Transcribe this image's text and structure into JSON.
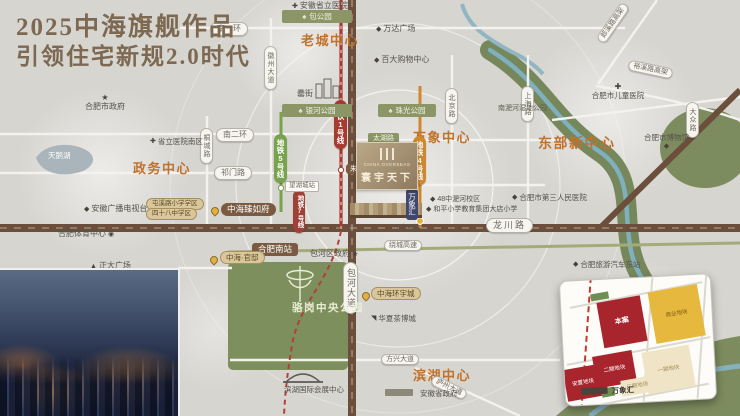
{
  "title": {
    "line1": "2025中海旗舰作品",
    "line2": "引领住宅新规2.0时代"
  },
  "centers": {
    "zhengwu": "政务中心",
    "laocheng": "老城中心",
    "wanxiang": "万象中心",
    "dongbu": "东部新中心",
    "binhu": "滨湖中心"
  },
  "roads": {
    "nanyihuan": "南一环",
    "nanerhuan": "南二环",
    "qimenlu": "祁门路",
    "tongchenglu": "桐城路",
    "huizhoudadao": "徽州大道",
    "beijinglu": "北京路",
    "shanghailu": "上海路",
    "longchuanlu": "龙川路",
    "baohedadao": "包河大道",
    "raochenggaosu": "绕城高速",
    "fangxingdadao": "方兴大道",
    "luzhoudadao": "庐州大道",
    "langxigaojia": "郎溪路高架",
    "yuxigaojia": "裕溪路高架",
    "taihulu": "太湖路",
    "feihelu": "淝河路",
    "dazhonglu": "大众路"
  },
  "metro": {
    "line1": "地铁1号线",
    "line4": "地铁4号线",
    "line5": "地铁5号线",
    "line7": "地铁7号线",
    "station_zhugang": "朱岗站",
    "station_wanghucheng": "望湖城站",
    "station_wangdaying": "王大郢站"
  },
  "pois": {
    "sheng_hospital": "安徽省立医院",
    "sheng_hospital_south": "省立医院南区",
    "baogongyuan": "包公园",
    "wanda": "万达广场",
    "baida": "百大购物中心",
    "leijie": "罍街",
    "yinhe_park": "银河公园",
    "zhuguang_park": "珠光公园",
    "hefei_gov": "合肥市政府",
    "tianehu": "天鹅湖",
    "tv_station": "安徽广播电视台",
    "sports_center": "合肥体育中心",
    "zhengda_plaza": "正大广场",
    "school_pill_a": "屯溪路小学学区",
    "school_pill_b": "四十八中学区",
    "children_hospital": "合肥市儿童医院",
    "wetland_park": "南淝河湿地公园",
    "museum": "合肥市博物馆",
    "hospital3": "合肥市第三人民医院",
    "school48": "48中淝河校区",
    "school_dadian": "和平小学教育集团大店小学",
    "south_station": "合肥南站",
    "baohe_gov": "包河区政府",
    "luogang_park": "骆岗中央公园",
    "exhibition_center": "滨湖国际会展中心",
    "province_gov": "安徽省政府",
    "tea_city": "华夏茶博城",
    "east_bus_station": "合肥旅游汽车东站"
  },
  "projects": {
    "zhenrufu": "中海臻如府",
    "guandi": "中海·官邸",
    "huanyucheng": "中海环宇城",
    "logo_en": "CHINA OVERSEAS",
    "logo_name": "寰宇天下",
    "wanxianghui": "万象汇"
  },
  "inset": {
    "caption": "万象汇",
    "yellow": "商业地块",
    "red_main": "本案",
    "red_two": "二期地块",
    "red_resettle": "安置地块",
    "cream_one": "一期地块",
    "cream_three": "三期地块"
  },
  "colors": {
    "accent_orange": "#c0722c",
    "road_brown": "#6b4e3b",
    "metro_red": "#a93a31",
    "metro_orange": "#cf8830",
    "metro_green": "#79a24c",
    "park_green": "#7e8f5e",
    "title_brown": "#7d6952"
  }
}
